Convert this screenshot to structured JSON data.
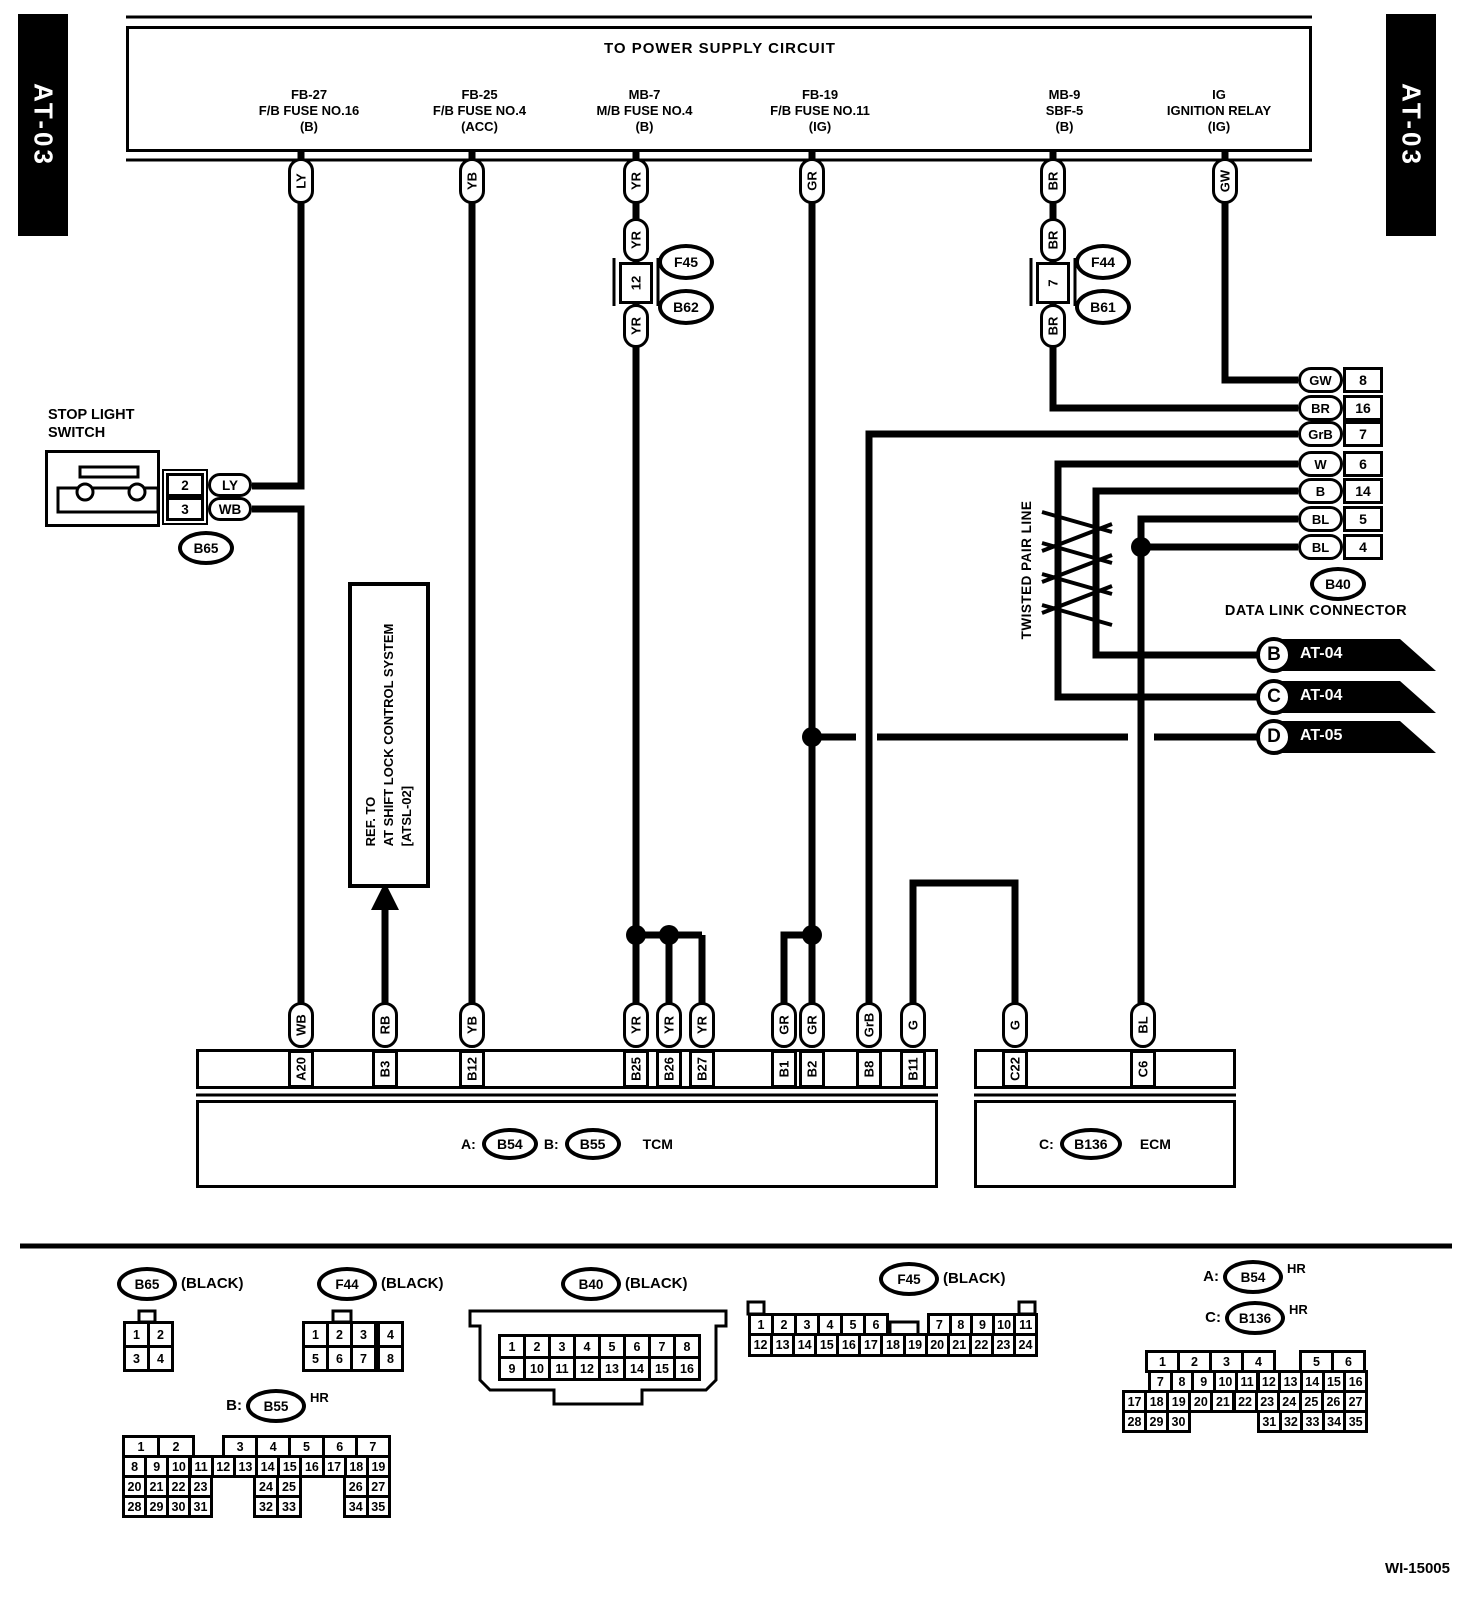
{
  "page": {
    "left_tab": "AT-03",
    "right_tab": "AT-03",
    "footer": "WI-15005",
    "ink": "#000000",
    "paper": "#ffffff"
  },
  "banner": {
    "title": "TO POWER SUPPLY CIRCUIT",
    "cells": [
      {
        "x": 220,
        "w": 178,
        "l1": "FB-27",
        "l2": "F/B FUSE NO.16",
        "l3": "(B)"
      },
      {
        "x": 398,
        "w": 163,
        "l1": "FB-25",
        "l2": "F/B FUSE NO.4",
        "l3": "(ACC)"
      },
      {
        "x": 561,
        "w": 167,
        "l1": "MB-7",
        "l2": "M/B FUSE NO.4",
        "l3": "(B)"
      },
      {
        "x": 728,
        "w": 184,
        "l1": "FB-19",
        "l2": "F/B FUSE NO.11",
        "l3": "(IG)"
      },
      {
        "x": 994,
        "w": 141,
        "l1": "MB-9",
        "l2": "SBF-5",
        "l3": "(B)"
      },
      {
        "x": 1135,
        "w": 168,
        "l1": "IG",
        "l2": "IGNITION RELAY",
        "l3": "(IG)"
      }
    ]
  },
  "top_labels": [
    {
      "t": "LY",
      "x": 301
    },
    {
      "t": "YB",
      "x": 472
    },
    {
      "t": "YR",
      "x": 636
    },
    {
      "t": "GR",
      "x": 812
    },
    {
      "t": "BR",
      "x": 1053
    },
    {
      "t": "GW",
      "x": 1225
    }
  ],
  "inline_connectors": [
    {
      "x": 636,
      "seg2": "YR",
      "boxnum": "12",
      "seg3": "YR",
      "oval_top": "F45",
      "oval_bottom": "B62"
    },
    {
      "x": 1053,
      "seg2": "BR",
      "boxnum": "7",
      "seg3": "BR",
      "oval_top": "F44",
      "oval_bottom": "B61"
    }
  ],
  "stop_light_switch": {
    "title1": "STOP LIGHT",
    "title2": "SWITCH",
    "pins": [
      {
        "num": "2",
        "color": "LY"
      },
      {
        "num": "3",
        "color": "WB"
      }
    ],
    "connector": "B65"
  },
  "shift_lock_ref": {
    "line1": "REF. TO",
    "line2": "AT SHIFT LOCK CONTROL SYSTEM",
    "line3": "[ATSL-02]"
  },
  "twisted_pair_label": "TWISTED PAIR LINE",
  "dlc": {
    "connector": "B40",
    "caption": "DATA LINK CONNECTOR",
    "pins": [
      {
        "c": "GW",
        "n": "8",
        "y": 380
      },
      {
        "c": "BR",
        "n": "16",
        "y": 408
      },
      {
        "c": "GrB",
        "n": "7",
        "y": 434
      },
      {
        "c": "W",
        "n": "6",
        "y": 464
      },
      {
        "c": "B",
        "n": "14",
        "y": 491
      },
      {
        "c": "BL",
        "n": "5",
        "y": 519
      },
      {
        "c": "BL",
        "n": "4",
        "y": 547
      }
    ]
  },
  "flags": [
    {
      "letter": "B",
      "label": "AT-04",
      "y": 655
    },
    {
      "letter": "C",
      "label": "AT-04",
      "y": 697
    },
    {
      "letter": "D",
      "label": "AT-05",
      "y": 737
    }
  ],
  "tcm": {
    "pins": [
      {
        "p": "A20",
        "c": "WB",
        "x": 301
      },
      {
        "p": "B3",
        "c": "RB",
        "x": 385
      },
      {
        "p": "B12",
        "c": "YB",
        "x": 472
      },
      {
        "p": "B25",
        "c": "YR",
        "x": 636
      },
      {
        "p": "B26",
        "c": "YR",
        "x": 669
      },
      {
        "p": "B27",
        "c": "YR",
        "x": 702
      },
      {
        "p": "B1",
        "c": "GR",
        "x": 784
      },
      {
        "p": "B2",
        "c": "GR",
        "x": 812
      },
      {
        "p": "B8",
        "c": "GrB",
        "x": 869
      },
      {
        "p": "B11",
        "c": "G",
        "x": 913
      }
    ],
    "a_prefix": "A:",
    "a_conn": "B54",
    "b_prefix": "B:",
    "b_conn": "B55",
    "label": "TCM"
  },
  "ecm": {
    "pins": [
      {
        "p": "C22",
        "c": "G",
        "x": 1015
      },
      {
        "p": "C6",
        "c": "BL",
        "x": 1143
      }
    ],
    "c_prefix": "C:",
    "c_conn": "B136",
    "label": "ECM"
  },
  "pinout_headers": [
    {
      "id": "b65",
      "prefix": "",
      "name": "B65",
      "tag": "(BLACK)",
      "cx": 147,
      "cy": 1284
    },
    {
      "id": "f44",
      "prefix": "",
      "name": "F44",
      "tag": "(BLACK)",
      "cx": 347,
      "cy": 1284
    },
    {
      "id": "b40",
      "prefix": "",
      "name": "B40",
      "tag": "(BLACK)",
      "cx": 591,
      "cy": 1284
    },
    {
      "id": "f45",
      "prefix": "",
      "name": "F45",
      "tag": "(BLACK)",
      "cx": 909,
      "cy": 1279
    },
    {
      "id": "b54",
      "prefix": "A:",
      "name": "B54",
      "tag": "HR",
      "cx": 1253,
      "cy": 1277
    },
    {
      "id": "b136",
      "prefix": "C:",
      "name": "B136",
      "tag": "HR",
      "cx": 1255,
      "cy": 1318
    },
    {
      "id": "b55",
      "prefix": "B:",
      "name": "B55",
      "tag": "HR",
      "cx": 276,
      "cy": 1406
    }
  ],
  "grids": [
    {
      "id": "b65",
      "rows": [
        {
          "y": 1321,
          "h": 27,
          "segs": [
            {
              "x": 123,
              "w": 24,
              "cells": [
                "1",
                "2"
              ]
            }
          ]
        },
        {
          "y": 1345,
          "h": 27,
          "segs": [
            {
              "x": 123,
              "w": 24,
              "cells": [
                "3",
                "4"
              ]
            }
          ]
        }
      ]
    },
    {
      "id": "f44",
      "rows": [
        {
          "y": 1321,
          "h": 27,
          "segs": [
            {
              "x": 302,
              "w": 24,
              "cells": [
                "1",
                "2",
                "3"
              ]
            },
            {
              "x": 377,
              "w": 24,
              "cells": [
                "4"
              ]
            }
          ]
        },
        {
          "y": 1345,
          "h": 27,
          "segs": [
            {
              "x": 302,
              "w": 24,
              "cells": [
                "5",
                "6",
                "7"
              ]
            },
            {
              "x": 377,
              "w": 24,
              "cells": [
                "8"
              ]
            }
          ]
        }
      ]
    },
    {
      "id": "b40",
      "rows": [
        {
          "y": 1334,
          "h": 25,
          "segs": [
            {
              "x": 498,
              "w": 25,
              "cells": [
                "1",
                "2",
                "3",
                "4",
                "5",
                "6",
                "7",
                "8"
              ]
            }
          ]
        },
        {
          "y": 1356,
          "h": 25,
          "segs": [
            {
              "x": 498,
              "w": 25,
              "cells": [
                "9",
                "10",
                "11",
                "12",
                "13",
                "14",
                "15",
                "16"
              ]
            }
          ]
        }
      ]
    },
    {
      "id": "f45",
      "rows": [
        {
          "y": 1313,
          "h": 23,
          "segs": [
            {
              "x": 748,
              "w": 23,
              "cells": [
                "1",
                "2",
                "3",
                "4",
                "5",
                "6"
              ]
            },
            {
              "x": 927,
              "w": 21.6,
              "cells": [
                "7",
                "8",
                "9",
                "10",
                "11"
              ]
            }
          ]
        },
        {
          "y": 1333,
          "h": 24,
          "segs": [
            {
              "x": 748,
              "w": 22.08,
              "cells": [
                "12",
                "13",
                "14",
                "15",
                "16",
                "17",
                "18",
                "19",
                "20",
                "21",
                "22",
                "23",
                "24"
              ]
            }
          ]
        }
      ]
    },
    {
      "id": "b54",
      "rows": [
        {
          "y": 1350,
          "h": 23,
          "segs": [
            {
              "x": 1145,
              "w": 32,
              "cells": [
                "1",
                "2",
                "3",
                "4"
              ]
            },
            {
              "x": 1299,
              "w": 32,
              "cells": [
                "5",
                "6"
              ]
            }
          ]
        },
        {
          "y": 1370,
          "h": 23,
          "segs": [
            {
              "x": 1148,
              "w": 21.7,
              "cells": [
                "7",
                "8",
                "9",
                "10",
                "11",
                "12",
                "13",
                "14",
                "15",
                "16"
              ]
            }
          ]
        },
        {
          "y": 1390,
          "h": 23,
          "segs": [
            {
              "x": 1122,
              "w": 22.1,
              "cells": [
                "17",
                "18",
                "19",
                "20",
                "21",
                "22",
                "23",
                "24",
                "25",
                "26",
                "27"
              ]
            }
          ]
        },
        {
          "y": 1410,
          "h": 23,
          "segs": [
            {
              "x": 1122,
              "w": 22,
              "cells": [
                "28",
                "29",
                "30"
              ]
            },
            {
              "x": 1257,
              "w": 21.6,
              "cells": [
                "31",
                "32",
                "33",
                "34",
                "35"
              ]
            }
          ]
        }
      ]
    },
    {
      "id": "b55",
      "rows": [
        {
          "y": 1435,
          "h": 23,
          "segs": [
            {
              "x": 122,
              "w": 35,
              "cells": [
                "1",
                "2"
              ]
            },
            {
              "x": 222,
              "w": 33.2,
              "cells": [
                "3",
                "4",
                "5",
                "6",
                "7"
              ]
            }
          ]
        },
        {
          "y": 1455,
          "h": 23,
          "segs": [
            {
              "x": 122,
              "w": 22.17,
              "cells": [
                "8",
                "9",
                "10",
                "11",
                "12",
                "13",
                "14",
                "15",
                "16",
                "17",
                "18",
                "19"
              ]
            }
          ]
        },
        {
          "y": 1475,
          "h": 23,
          "segs": [
            {
              "x": 122,
              "w": 22,
              "cells": [
                "20",
                "21",
                "22",
                "23"
              ]
            },
            {
              "x": 253,
              "w": 23,
              "cells": [
                "24",
                "25"
              ]
            },
            {
              "x": 343,
              "w": 22.5,
              "cells": [
                "26",
                "27"
              ]
            }
          ]
        },
        {
          "y": 1495,
          "h": 23,
          "segs": [
            {
              "x": 122,
              "w": 22,
              "cells": [
                "28",
                "29",
                "30",
                "31"
              ]
            },
            {
              "x": 253,
              "w": 23,
              "cells": [
                "32",
                "33"
              ]
            },
            {
              "x": 343,
              "w": 22.5,
              "cells": [
                "34",
                "35"
              ]
            }
          ]
        }
      ]
    }
  ]
}
